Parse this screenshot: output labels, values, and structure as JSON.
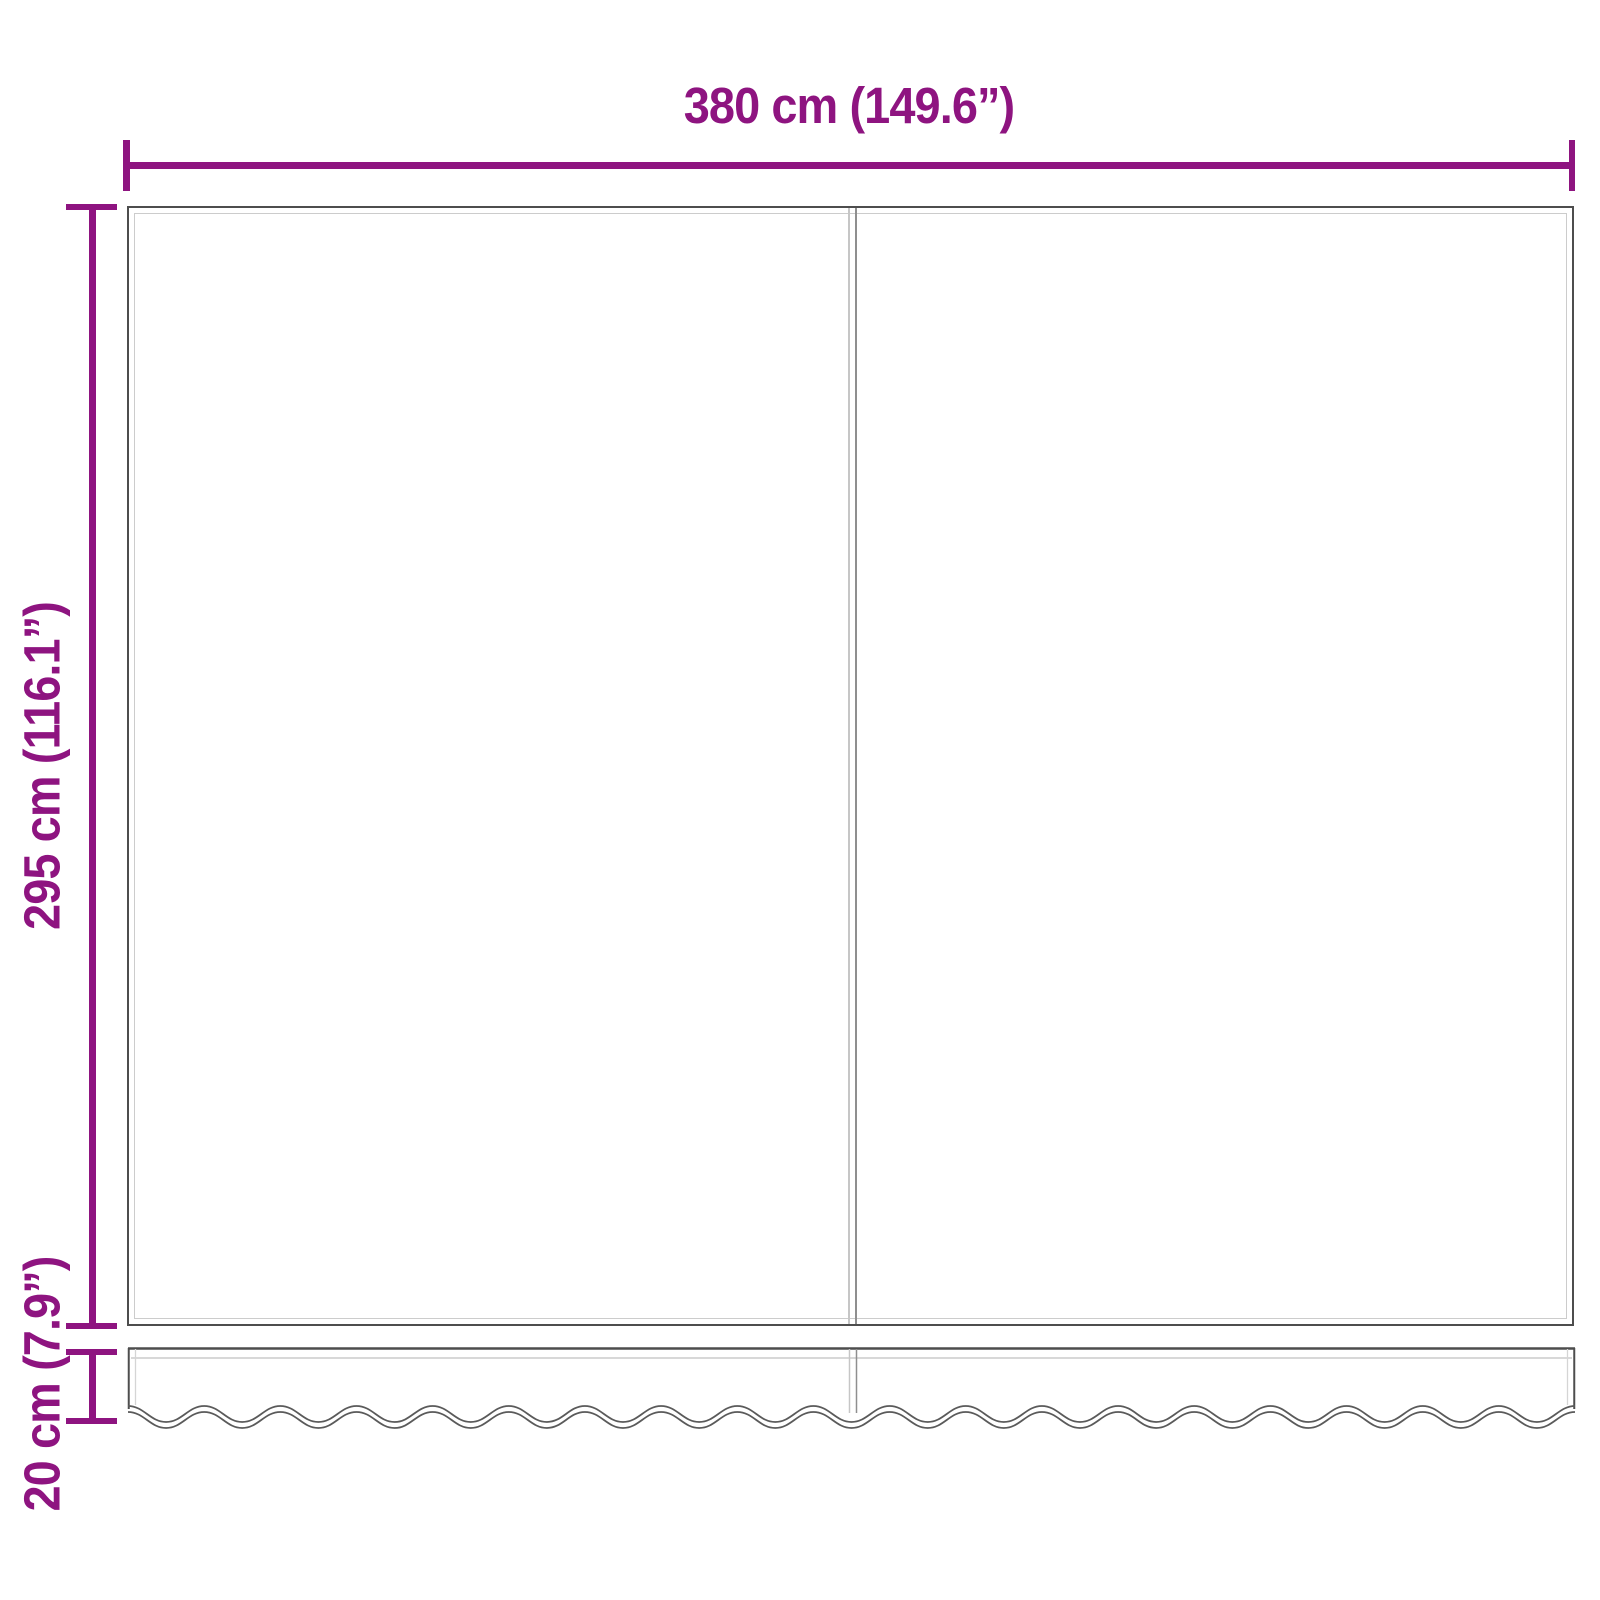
{
  "dimensions": {
    "width_label": "380 cm (149.6”)",
    "height_label": "295 cm (116.1”)",
    "valance_label": "20 cm (7.9”)"
  },
  "colors": {
    "dimension_lines": "#8e1480",
    "fabric_outline": "#4d4d4d",
    "hem_lines": "#cccccc",
    "seam_line": "#8f8f8f",
    "background": "#ffffff"
  }
}
